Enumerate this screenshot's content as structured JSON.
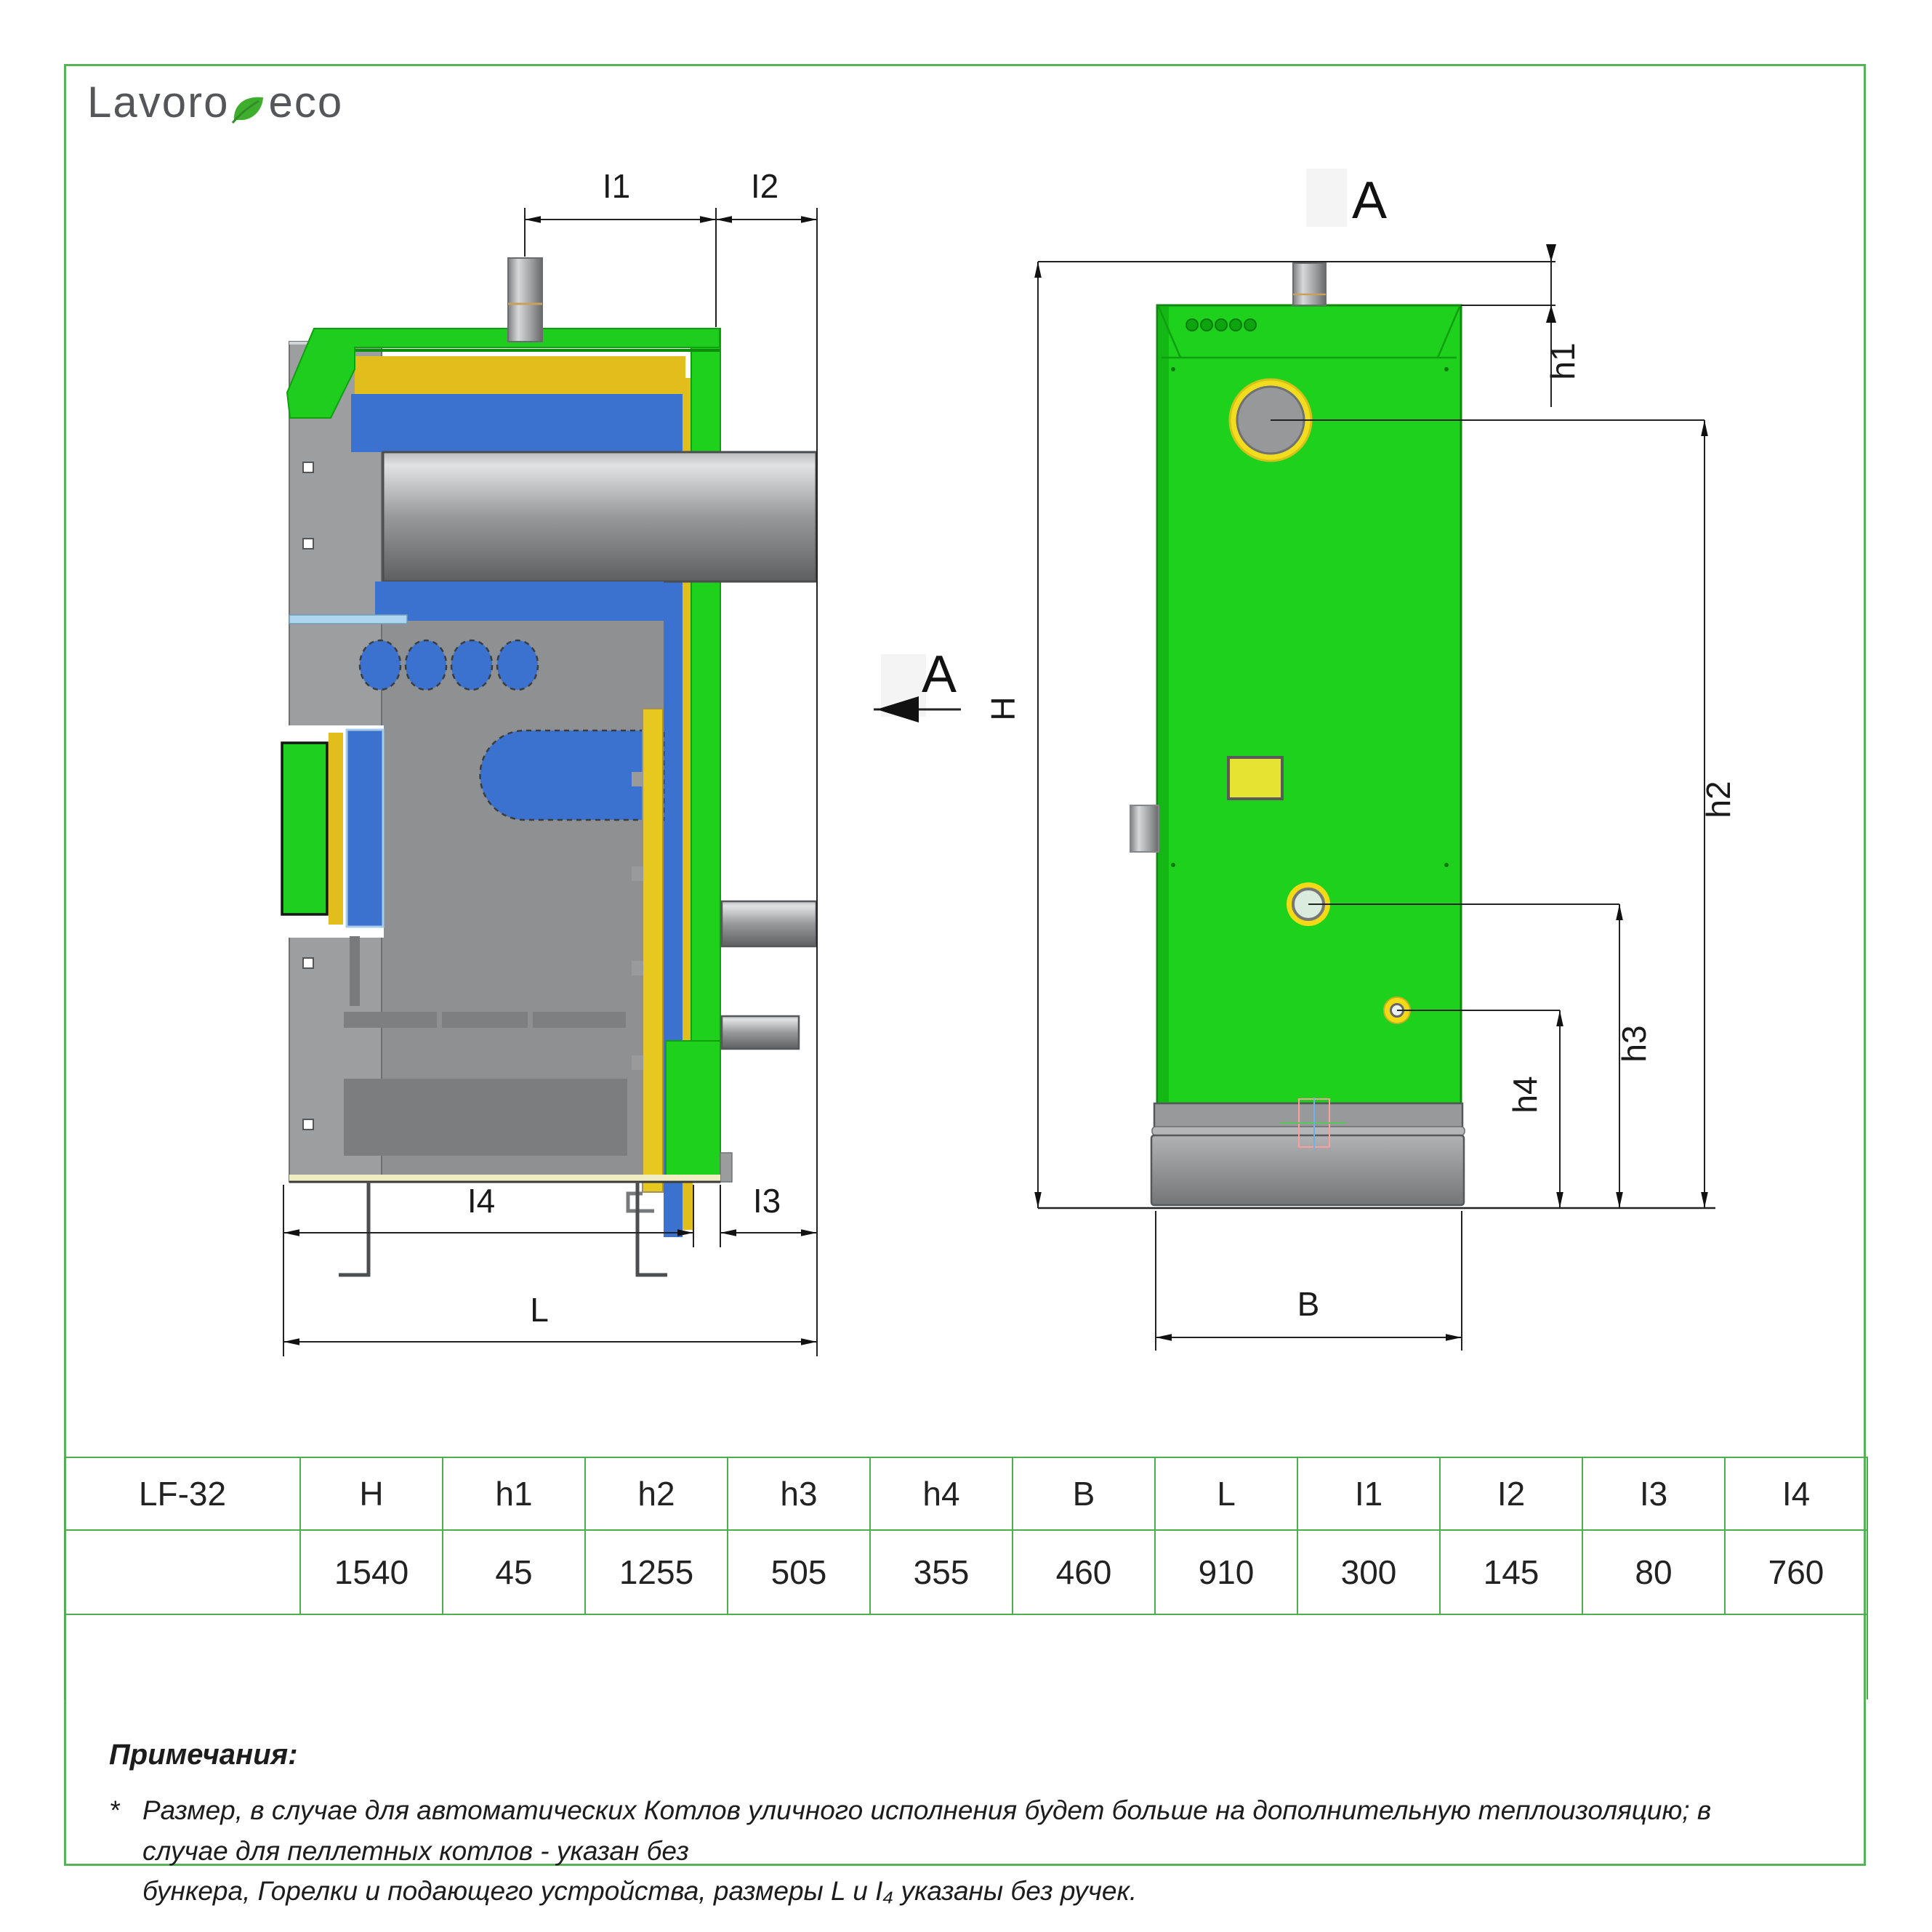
{
  "logo": {
    "text_primary": "Lavoro",
    "text_secondary": "eco"
  },
  "drawing": {
    "side_view": {
      "dim_i1": "I1",
      "dim_i2": "I2",
      "dim_i3": "I3",
      "dim_i4": "I4",
      "dim_l": "L",
      "section_label": "A"
    },
    "front_view": {
      "view_label": "A",
      "dim_h": "H",
      "dim_h1": "h1",
      "dim_h2": "h2",
      "dim_h3": "h3",
      "dim_h4": "h4",
      "dim_b": "B"
    }
  },
  "table": {
    "model": "LF-32",
    "headers": [
      "H",
      "h1",
      "h2",
      "h3",
      "h4",
      "B",
      "L",
      "I1",
      "I2",
      "I3",
      "I4"
    ],
    "values": [
      "1540",
      "45",
      "1255",
      "505",
      "355",
      "460",
      "910",
      "300",
      "145",
      "80",
      "760"
    ]
  },
  "notes": {
    "title": "Примечания:",
    "marker": "*",
    "line1": "Размер, в случае для автоматических Котлов уличного исполнения будет больше на дополнительную теплоизоляцию; в случае для пеллетных котлов - указан без",
    "line2": "бункера, Горелки и подающего устройства, размеры L и I₄ указаны без ручек."
  },
  "colors": {
    "accent_green": "#4cae4c",
    "body_green": "#1dd11d",
    "insulation_yellow": "#e2be1c",
    "water_blue": "#3b72cf",
    "metal_gray": "#8f9193"
  }
}
